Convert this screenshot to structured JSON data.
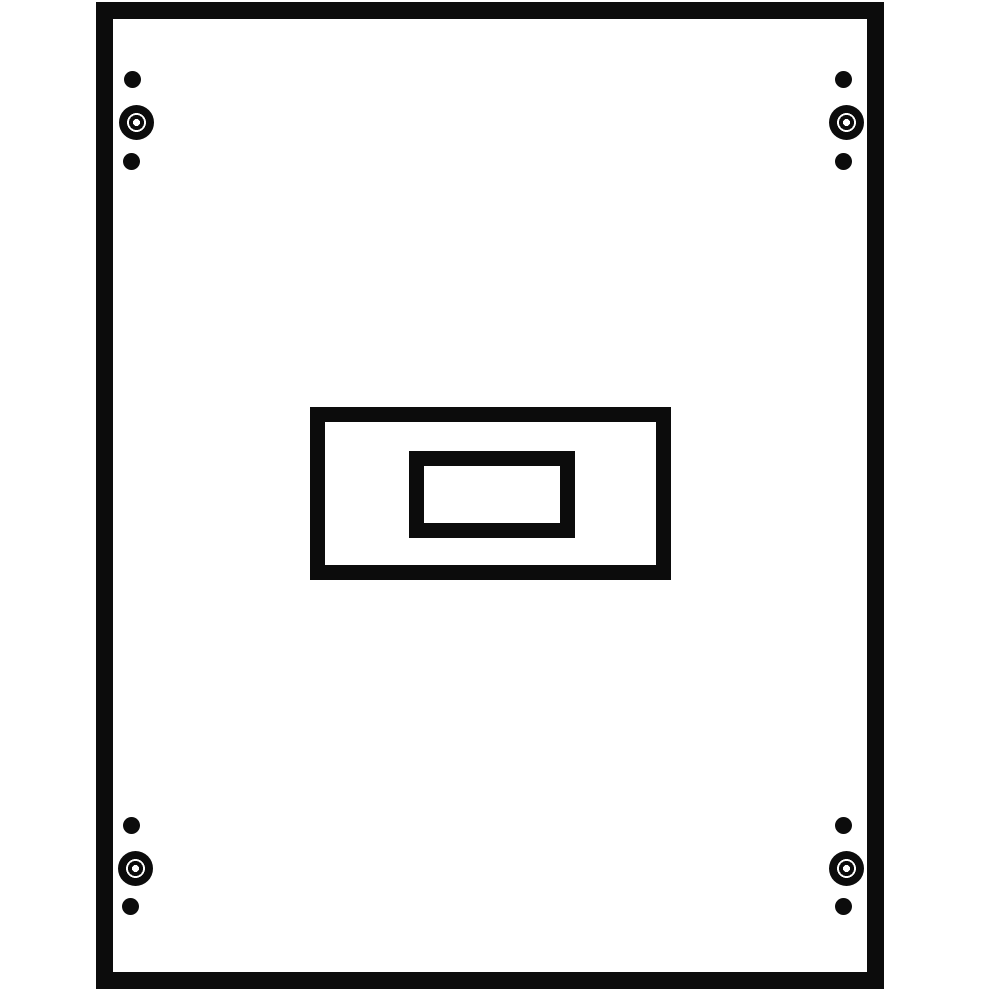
{
  "title": "mounting-panel-technical-drawing",
  "description": "Black-and-white technical line drawing of a rectangular mounting panel: thick black outer frame, four corner screw-hole groups (small hole, large screw head with centre bore, small hole), and a centred double-rectangle knockout cutout.",
  "colors": {
    "ink": "#0c0c0c",
    "surface": "#ffffff"
  },
  "canvas": {
    "width": 1000,
    "height": 1000
  },
  "frame": {
    "x": 96,
    "y": 2,
    "width": 788,
    "height": 987,
    "stroke": 17
  },
  "cutouts": {
    "outer": {
      "x": 310,
      "y": 407,
      "width": 361,
      "height": 173,
      "stroke": 15
    },
    "inner": {
      "x": 409,
      "y": 451,
      "width": 166,
      "height": 87,
      "stroke": 15
    }
  },
  "screw_groups": [
    {
      "id": "top-left",
      "dots": [
        {
          "type": "small",
          "cx": 132,
          "cy": 79,
          "d": 17
        },
        {
          "type": "large",
          "cx": 136,
          "cy": 122,
          "d": 35,
          "hole_d": 8
        },
        {
          "type": "small",
          "cx": 131,
          "cy": 161,
          "d": 17
        }
      ]
    },
    {
      "id": "top-right",
      "dots": [
        {
          "type": "small",
          "cx": 843,
          "cy": 79,
          "d": 17
        },
        {
          "type": "large",
          "cx": 846,
          "cy": 122,
          "d": 35,
          "hole_d": 8
        },
        {
          "type": "small",
          "cx": 843,
          "cy": 161,
          "d": 17
        }
      ]
    },
    {
      "id": "bottom-left",
      "dots": [
        {
          "type": "small",
          "cx": 131,
          "cy": 825,
          "d": 17
        },
        {
          "type": "large",
          "cx": 135,
          "cy": 868,
          "d": 35,
          "hole_d": 8
        },
        {
          "type": "small",
          "cx": 130,
          "cy": 906,
          "d": 17
        }
      ]
    },
    {
      "id": "bottom-right",
      "dots": [
        {
          "type": "small",
          "cx": 843,
          "cy": 825,
          "d": 17
        },
        {
          "type": "large",
          "cx": 846,
          "cy": 868,
          "d": 35,
          "hole_d": 8
        },
        {
          "type": "small",
          "cx": 843,
          "cy": 906,
          "d": 17
        }
      ]
    }
  ]
}
